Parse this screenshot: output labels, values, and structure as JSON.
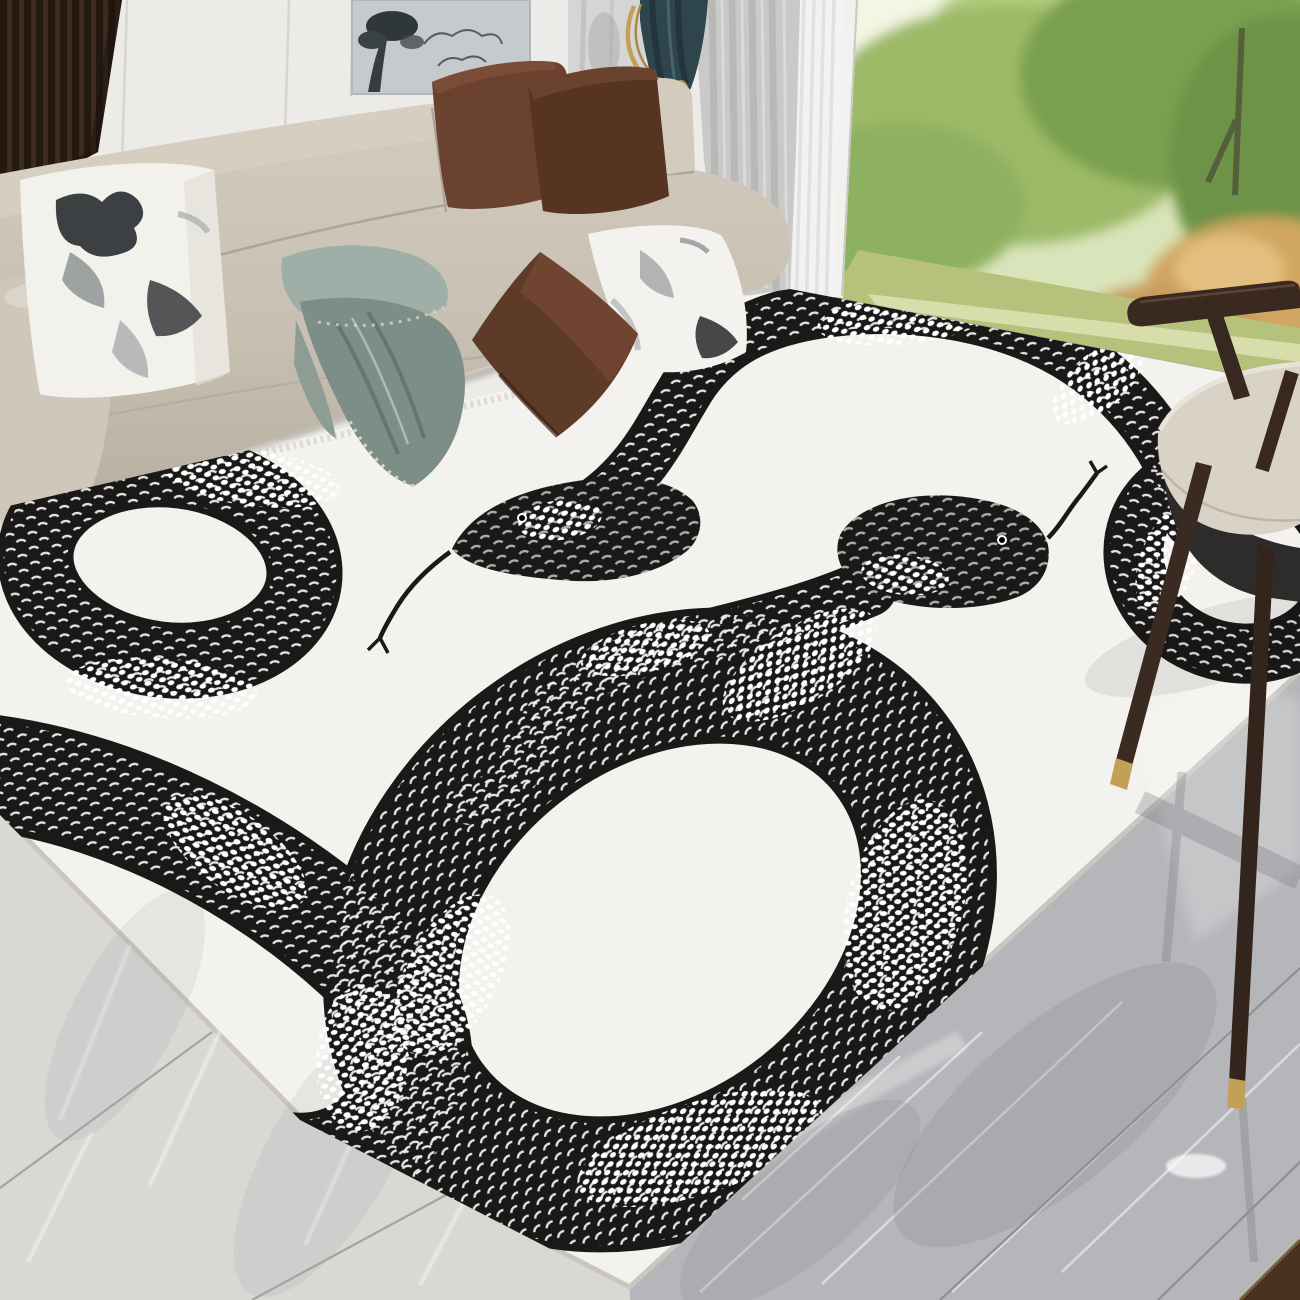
{
  "scene": {
    "type": "product-photo",
    "setting": "modern living room with floor-to-ceiling window",
    "subject": "white area rug with two hand-drawn black snakes",
    "objects": {
      "rug": "white snake-print area rug",
      "snakes": "black illustrated snakes with white scale texture and forked tongues",
      "sofa": "beige fabric sofa",
      "brown_pillows": "dark brown velvet cushions",
      "ink_pillows": "white cushions with black ink landscape print",
      "blanket": "sage green throw blanket with beaded hem",
      "chair": "dark wood accent chair with beige seat cushion and brass leg tips",
      "window": "garden view with green trees, autumn shrub and lawn",
      "curtain_dark": "dark teal curtain with gold rope tieback",
      "curtain_gray": "light gray curtain",
      "curtain_sheer": "white sheer curtain",
      "floor_left": "light gray marble tiles",
      "floor_right": "polished dark gray marble tiles",
      "wall_art": "ink landscape wall panel",
      "slat_panel": "dark wood slat wall panel"
    }
  },
  "palette": {
    "rug_white": "#f4f2ee",
    "snake_black": "#1b1917",
    "scale_white": "#ffffff",
    "marble_left": "#d9d8d5",
    "marble_right": "#b4b6b9",
    "sofa_beige": "#c8c0b2",
    "pillow_brown": "#5e3a28",
    "blanket_sage": "#7c8e87",
    "curtain_teal": "#2e454e",
    "curtain_gray": "#c9c9c7",
    "sheer_white": "#f1f2f1",
    "wood_dark": "#3a2920",
    "brass_gold": "#c2a157",
    "foliage_green": "#9cba68",
    "foliage_autumn": "#d0a660",
    "grass_green": "#b6c27b",
    "wall_white": "#ecebe7",
    "panel_gray": "#c6cacc",
    "slat_brown": "#241911",
    "rug_border": "#c9c6c0",
    "wedge_brown": "#47311f"
  }
}
